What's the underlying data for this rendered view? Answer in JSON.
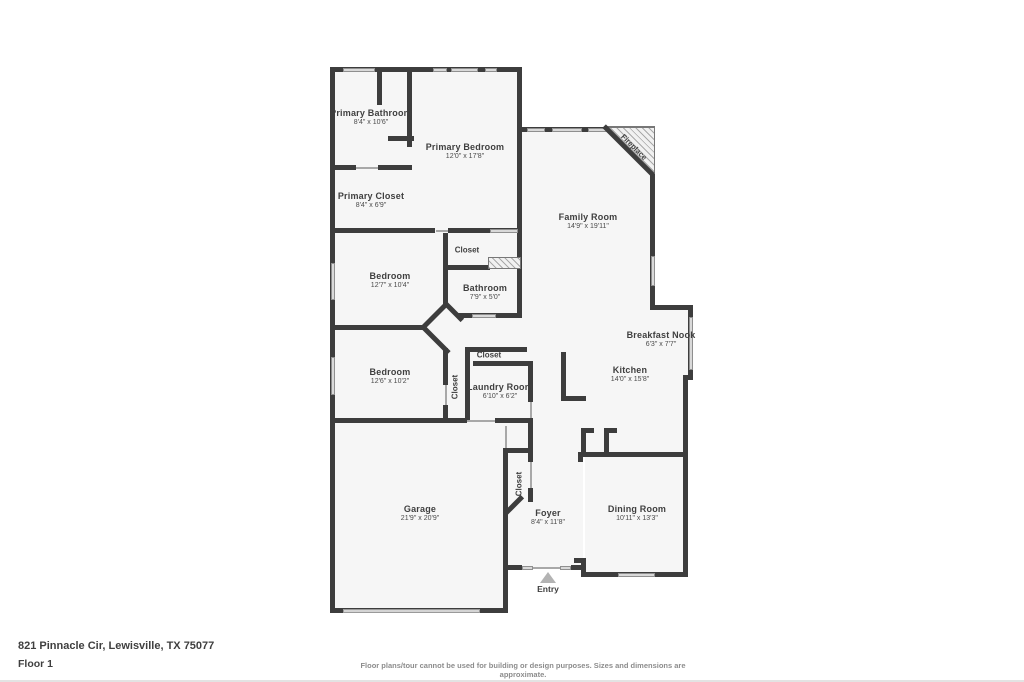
{
  "plan": {
    "wall_color": "#3d3d3d",
    "room_fill": "#f6f6f6",
    "rooms": {
      "primary_bathroom": {
        "name": "Primary Bathroom",
        "dims": "8'4\" x 10'6\""
      },
      "primary_bedroom": {
        "name": "Primary Bedroom",
        "dims": "12'0\" x 17'8\""
      },
      "primary_closet": {
        "name": "Primary Closet",
        "dims": "8'4\" x 6'9\""
      },
      "family_room": {
        "name": "Family Room",
        "dims": "14'9\" x 19'11\""
      },
      "bedroom_1": {
        "name": "Bedroom",
        "dims": "12'7\" x 10'4\""
      },
      "bathroom": {
        "name": "Bathroom",
        "dims": "7'9\" x 5'0\""
      },
      "bedroom_2": {
        "name": "Bedroom",
        "dims": "12'6\" x 10'2\""
      },
      "laundry_room": {
        "name": "Laundry Room",
        "dims": "6'10\" x 6'2\""
      },
      "breakfast_nook": {
        "name": "Breakfast Nook",
        "dims": "6'3\" x 7'7\""
      },
      "kitchen": {
        "name": "Kitchen",
        "dims": "14'0\" x 15'8\""
      },
      "garage": {
        "name": "Garage",
        "dims": "21'9\" x 20'9\""
      },
      "foyer": {
        "name": "Foyer",
        "dims": "8'4\" x 11'8\""
      },
      "dining_room": {
        "name": "Dining Room",
        "dims": "10'11\" x 13'3\""
      }
    },
    "closets": {
      "closet_bedroom1": {
        "label": "Closet"
      },
      "closet_hall": {
        "label": "Closet"
      },
      "closet_bedroom2": {
        "label": "Closet"
      },
      "closet_foyer": {
        "label": "Closet"
      }
    },
    "annotations": {
      "fireplace": "Fireplace",
      "entry": "Entry"
    }
  },
  "footer": {
    "address": "821 Pinnacle Cir, Lewisville, TX 75077",
    "floor_label": "Floor 1",
    "disclaimer": "Floor plans/tour cannot be used for building or design purposes. Sizes and dimensions are approximate."
  }
}
